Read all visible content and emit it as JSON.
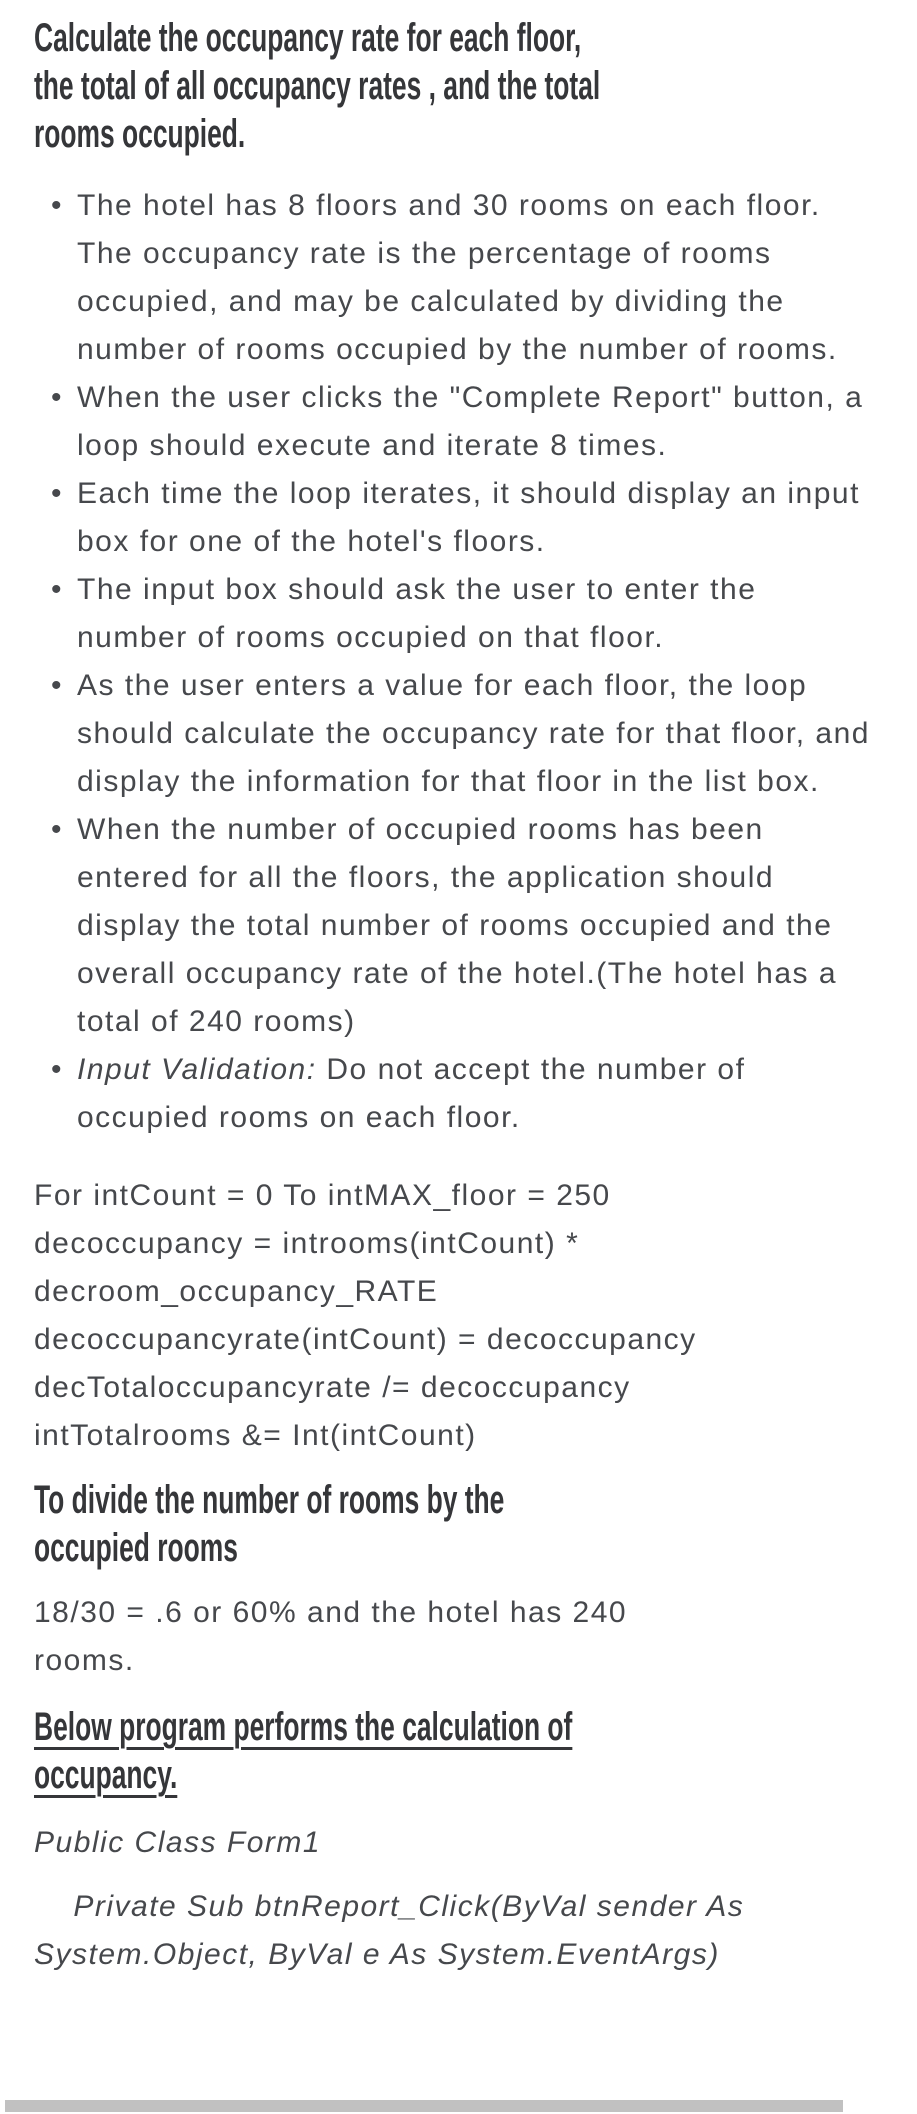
{
  "colors": {
    "background": "#ffffff",
    "text": "#46484c",
    "heading": "#353639",
    "scrollbar_thumb": "#c1c1c1"
  },
  "document": {
    "bullet_char": "•",
    "heading": "Calculate the occupancy rate for each floor,\nthe total of all occupancy rates , and the total\nrooms occupied.",
    "bullets": [
      {
        "text": "The hotel has 8 floors and 30 rooms on each floor. The occupancy rate is the percentage of rooms occupied, and may be calculated by dividing the number of rooms occupied by the number of rooms."
      },
      {
        "text": "When the user clicks the \"Complete Report\" button, a loop should execute and iterate 8 times."
      },
      {
        "text": "Each time the loop iterates, it should display an input box for one of the hotel's floors."
      },
      {
        "text": "The input box should ask the user to enter the number of rooms occupied on that floor."
      },
      {
        "text": "As the user enters a value for each floor, the loop should calculate the occupancy rate for that floor, and display the information for that floor in the list box."
      },
      {
        "text": "When the number of occupied rooms has been entered for all the floors, the application should display the total number of rooms occupied and the overall occupancy rate of the hotel.(The hotel has a total of 240 rooms)"
      },
      {
        "italic_lead": "Input Validation:",
        "text": " Do not accept the number of occupied rooms on each floor."
      }
    ],
    "loop_code": "For intCount = 0 To intMAX_floor = 250\ndecoccupancy = introoms(intCount) *\ndecroom_occupancy_RATE\ndecoccupancyrate(intCount) = decoccupancy\ndecTotaloccupancyrate /= decoccupancy\nintTotalrooms &= Int(intCount)",
    "divide_heading": "To divide the number of rooms by the\noccupied rooms",
    "ratio_text": "18/30 = .6 or 60% and the hotel has 240\nrooms.",
    "below_heading": "Below program performs the calculation of\noccupancy.",
    "vb_class_line": "Public Class Form1",
    "vb_sub_line": "    Private Sub btnReport_Click(ByVal sender As\nSystem.Object, ByVal e As System.EventArgs)"
  }
}
